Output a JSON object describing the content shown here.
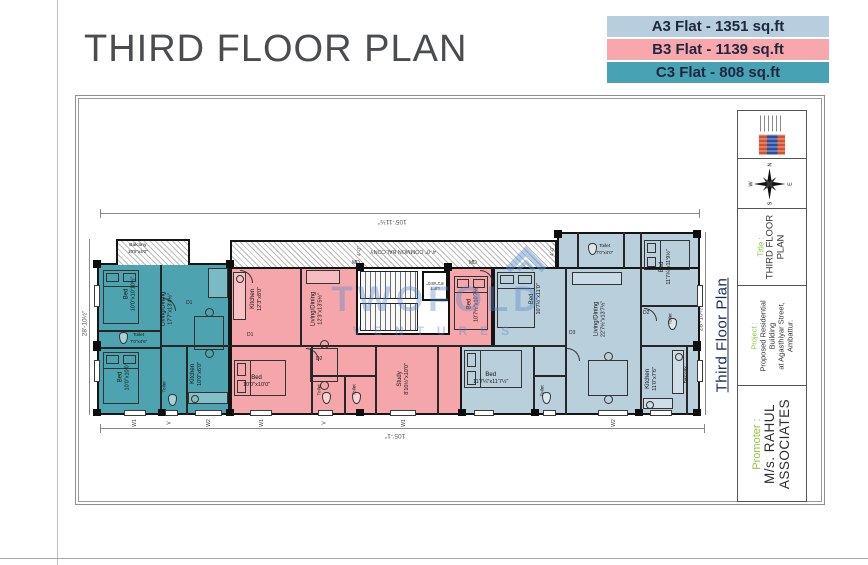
{
  "page": {
    "heading": "THIRD FLOOR PLAN"
  },
  "legend": [
    {
      "flat": "A3",
      "label": "A3 Flat - 1351 sq.ft",
      "color": "#b6cedd"
    },
    {
      "flat": "B3",
      "label": "B3 Flat - 1139 sq.ft",
      "color": "#f8a8ac"
    },
    {
      "flat": "C3",
      "label": "C3 Flat - 808 sq.ft",
      "color": "#47a2b3"
    }
  ],
  "titleblock": {
    "compass": {
      "n": "N",
      "e": "E",
      "s": "S",
      "w": "W"
    },
    "title_label": "Title :",
    "title_line1": "THIRD FLOOR",
    "title_line2": "PLAN",
    "project_label": "Project :",
    "project_line1": "Proposed Residential Building",
    "project_line2": "at Agasthiyar Street, Ambattur.",
    "promoter_label": "Promoter :",
    "promoter_line1": "M/s. RAHUL",
    "promoter_line2": "ASSOCIATES"
  },
  "plan": {
    "side_label": "Third Floor Plan",
    "dims": {
      "top": "105'-11½\"",
      "bottom": "105'-1\"",
      "side": "28'-10½\""
    },
    "common_balcony": "4'-0\" COMMON BALCONY",
    "balcony_width": "4'-0\"",
    "lift": {
      "name": "LIFT",
      "dims": "8'1\"x5'0\""
    },
    "openings": {
      "w1": "W1",
      "w2": "W2",
      "v": "V",
      "d1": "D1",
      "d2": "D2",
      "d3": "D3",
      "md": "MD"
    },
    "flats": {
      "c3": {
        "id": "C3",
        "rooms": [
          {
            "name": "Balcony",
            "dims": "10'5\"x4'0\""
          },
          {
            "name": "Bed",
            "dims": "10'0\"x10'10½\""
          },
          {
            "name": "Living/Dining",
            "dims": "17'7\"x13'4½\""
          },
          {
            "name": "Toilet",
            "dims": "7'0\"x4'6\""
          },
          {
            "name": "Bed",
            "dims": "10'0\"x10'0\""
          },
          {
            "name": "Kitchen",
            "dims": "10'0\"x6'0\""
          },
          {
            "name": "Toilet",
            "dims": "4'0\"x7'0\""
          }
        ]
      },
      "b3": {
        "id": "B3",
        "rooms": [
          {
            "name": "Kitchen",
            "dims": "12'3\"x8'0\""
          },
          {
            "name": "Living/Dining",
            "dims": "12'3\"x13'5½\""
          },
          {
            "name": "Bed",
            "dims": "10'0\"x10'0\""
          },
          {
            "name": "Bed",
            "dims": "10'7½\"x10'7½\""
          },
          {
            "name": "Study",
            "dims": "8'10½\"x10'0\""
          },
          {
            "name": "Toilet",
            "dims": "7'5\"x4'0\""
          },
          {
            "name": "Toilet",
            "dims": "4'0\"x7'5\""
          }
        ]
      },
      "a3": {
        "id": "A3",
        "rooms": [
          {
            "name": "Bed",
            "dims": "10'7½\"x11'0\""
          },
          {
            "name": "Bed",
            "dims": "11'7¼\"x11'7½\""
          },
          {
            "name": "Living/Dining",
            "dims": "22'7½\"x13'7½\""
          },
          {
            "name": "Bed",
            "dims": "11'7¼\"x11'9½\""
          },
          {
            "name": "Toilet",
            "dims": "7'0\"x4'0\""
          },
          {
            "name": "Kitchen",
            "dims": "11'0\"x7'6\""
          },
          {
            "name": "Toilet",
            "dims": "4'0\"x7'6\""
          },
          {
            "name": "Balcony",
            "dims": "11'0\"x3'6\""
          },
          {
            "name": "Toilet",
            "dims": "7'0\"x4'0\""
          }
        ]
      }
    }
  },
  "watermark": {
    "line1": "TWOFOLD",
    "line2": "VENTURES"
  },
  "colors": {
    "a3": "#b9cfdc",
    "b3": "#f5a6ab",
    "c3": "#4da4b0",
    "wall": "#151515",
    "accent_green": "#8fc43f",
    "side_label_blue": "#1c2a5e"
  }
}
